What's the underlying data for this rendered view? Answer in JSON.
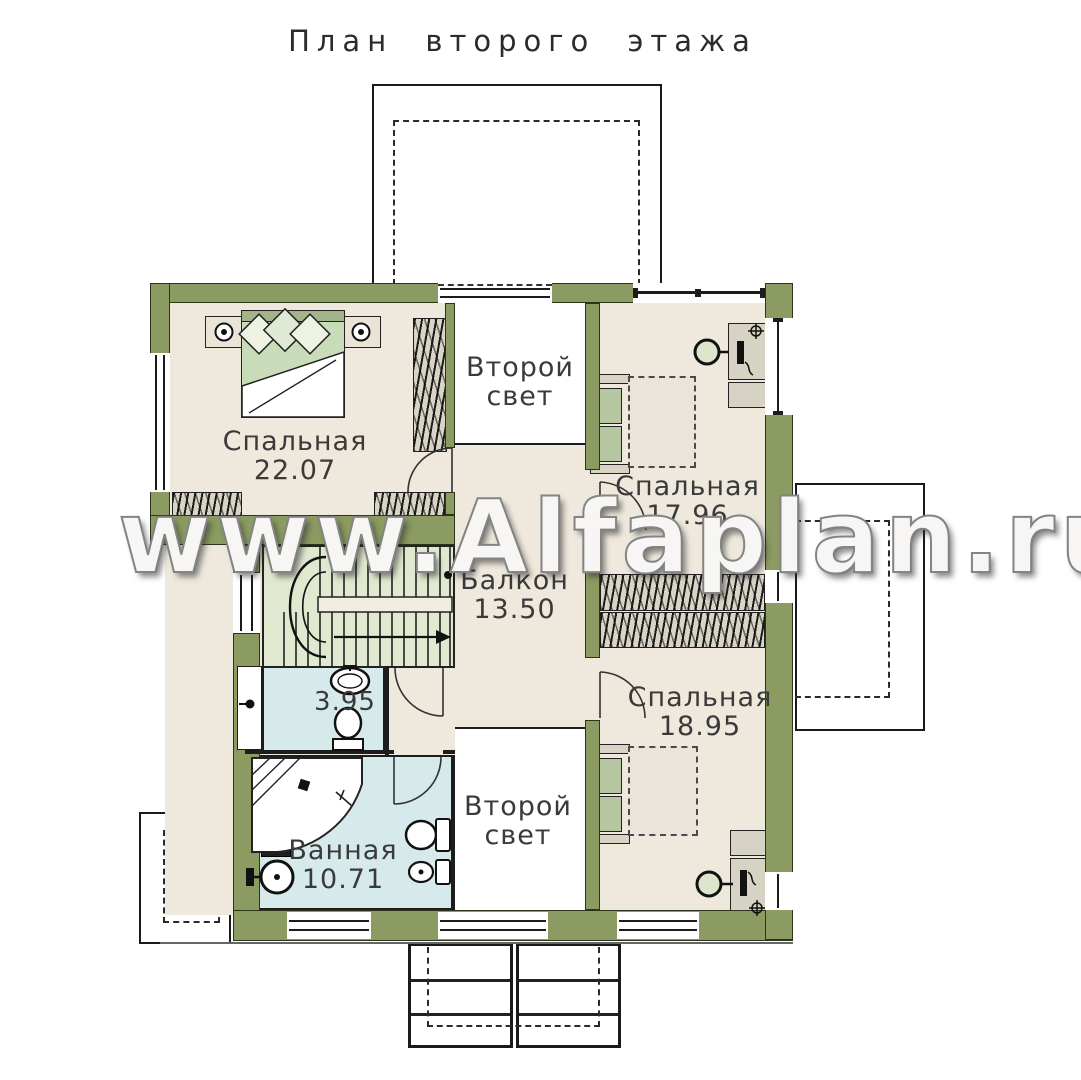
{
  "title": "План второго этажа",
  "watermark": "www.Alfaplan.ru",
  "rooms": {
    "bedroom_22": {
      "line1": "Спальная",
      "line2": "22.07"
    },
    "light_top": {
      "line1": "Второй",
      "line2": "свет"
    },
    "bedroom_17": {
      "line1": "Спальная",
      "line2": "17.96"
    },
    "balcony": {
      "line1": "Балкон",
      "line2": "13.50"
    },
    "wc": {
      "line1": "3.95",
      "line2": ""
    },
    "bedroom_18": {
      "line1": "Спальная",
      "line2": "18.95"
    },
    "bath": {
      "line1": "Ванная",
      "line2": "10.71"
    },
    "light_bottom": {
      "line1": "Второй",
      "line2": "свет"
    }
  },
  "colors": {
    "wall": "#8b9b61",
    "floor": "#efe9dd",
    "wet_room": "#d6eaec",
    "stairs": "#e0e9cf",
    "bed_green": "#c9dcba",
    "outline_black": "#1a1a1a"
  }
}
